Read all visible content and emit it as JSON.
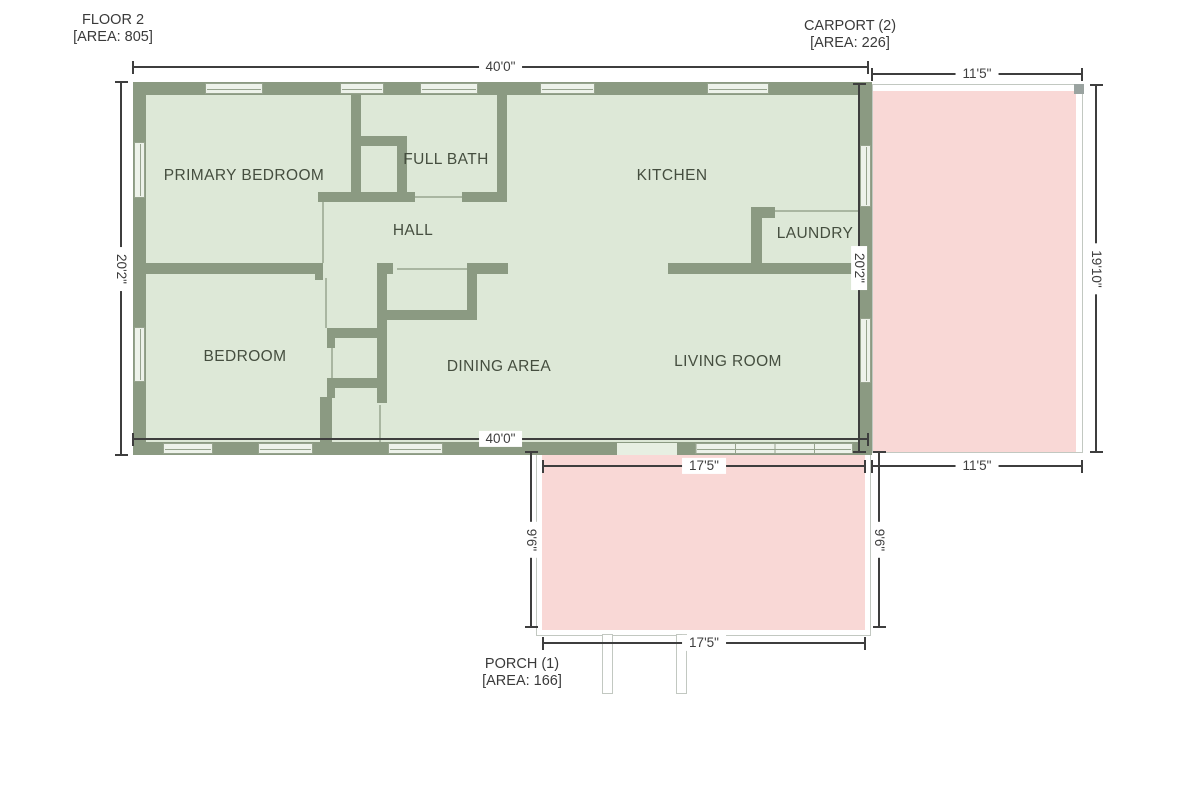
{
  "plan": {
    "floor": {
      "title": "FLOOR 2",
      "area": "[AREA: 805]"
    },
    "carport": {
      "title": "CARPORT (2)",
      "area": "[AREA: 226]"
    },
    "porch": {
      "title": "PORCH (1)",
      "area": "[AREA: 166]"
    },
    "rooms": {
      "primary_bedroom": "PRIMARY BEDROOM",
      "full_bath": "FULL BATH",
      "kitchen": "KITCHEN",
      "hall": "HALL",
      "laundry": "LAUNDRY",
      "bedroom": "BEDROOM",
      "dining_area": "DINING AREA",
      "living_room": "LIVING ROOM"
    },
    "dimensions": {
      "top_width": "40'0\"",
      "bottom_width": "40'0\"",
      "left_height": "20'2\"",
      "right_height": "20'2\"",
      "carport_width_top": "11'5\"",
      "carport_width_bottom": "11'5\"",
      "carport_height": "19'10\"",
      "porch_width_top": "17'5\"",
      "porch_width_bottom": "17'5\"",
      "porch_height_left": "9'6\"",
      "porch_height_right": "9'6\""
    },
    "colors": {
      "wall": "#8b9a82",
      "interior": "#dde8d7",
      "window_fill": "#edf2ea",
      "patio_fill": "#f9d8d6",
      "dimension_line": "#3e3e3e",
      "room_label": "#454e3f"
    }
  }
}
